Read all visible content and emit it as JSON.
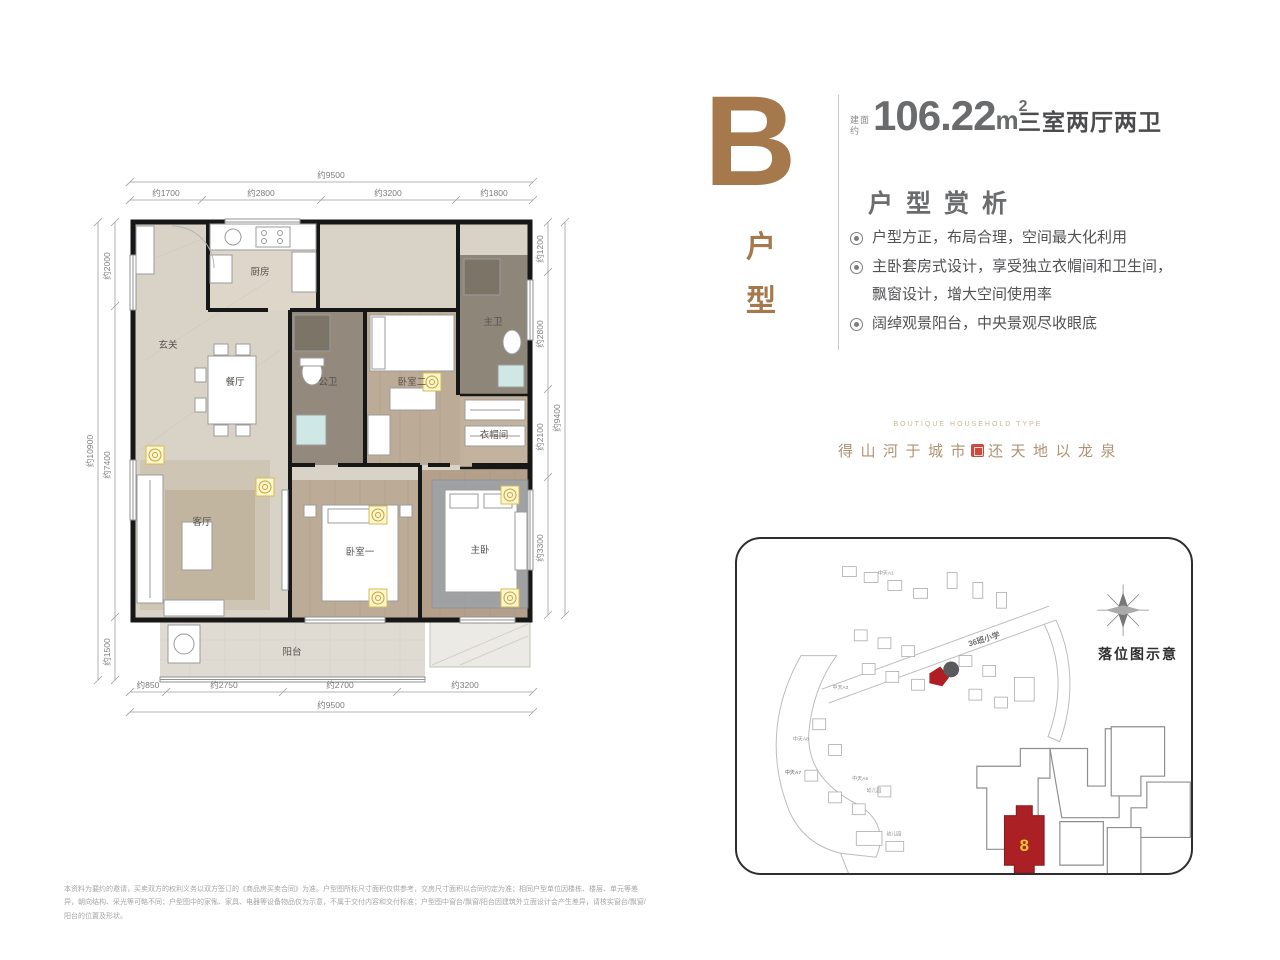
{
  "header": {
    "letter": "B",
    "letter_col": [
      "户",
      "型"
    ],
    "area_prefix_top": "建面",
    "area_prefix_bottom": "约",
    "area_value": "106.22",
    "area_unit": "m",
    "area_sup": "2",
    "layout": "三室两厅两卫",
    "section_title": "户型赏析",
    "accent_color": "#a5794b"
  },
  "features": [
    "户型方正，布局合理，空间最大化利用",
    "主卧套房式设计，享受独立衣帽间和卫生间，飘窗设计，增大空间使用率",
    "阔绰观景阳台，中央景观尽收眼底"
  ],
  "tagline": {
    "en": "BOUTIQUE HOUSEHOLD TYPE",
    "cn_left": "得山河于城市",
    "cn_right": "还天地以龙泉"
  },
  "floor_plan": {
    "rooms": {
      "entry": "玄关",
      "kitchen": "厨房",
      "dining": "餐厅",
      "guest_bath": "公卫",
      "bedroom2": "卧室二",
      "master_bath": "主卫",
      "closet": "衣帽间",
      "living": "客厅",
      "bedroom1": "卧室一",
      "master": "主卧",
      "balcony": "阳台"
    },
    "dims": {
      "top_total": "约9500",
      "top": [
        "约1700",
        "约2800",
        "约3200",
        "约1800"
      ],
      "left_total": "约10900",
      "left": [
        "约2000",
        "约7400",
        "约1500"
      ],
      "right_total": "约9400",
      "right": [
        "约1200",
        "约2800",
        "约2100",
        "约3300"
      ],
      "bottom_total": "约9500",
      "bottom": [
        "约850",
        "约2750",
        "约2700",
        "约3200"
      ]
    }
  },
  "site_map": {
    "title": "落位图示意",
    "building_number": "8",
    "school_label": "36班小学",
    "labels": [
      "中天A1",
      "中天A3",
      "中天A6",
      "中天A7",
      "中天A8",
      "幼儿园"
    ],
    "highlight_color": "#ab2025",
    "number_color": "#f6c62e"
  },
  "disclaimer": "本资料为要约的邀请，买卖双方的权利义务以双方签订的《商品房买卖合同》为准。户型图所标尺寸面积仅供参考，交房尺寸面积以合同约定为准；相同户型单位因楼栋、楼层、单元等差异，朝向结构、采光等可略不同；户型图中的家俬、家具、电器等设备物品仅为示意，不属于交付内容和交付标准；户型图中窗台/飘窗/阳台因建筑外立面设计会产生差异，请核实窗台/飘窗/阳台的位置及形状。"
}
